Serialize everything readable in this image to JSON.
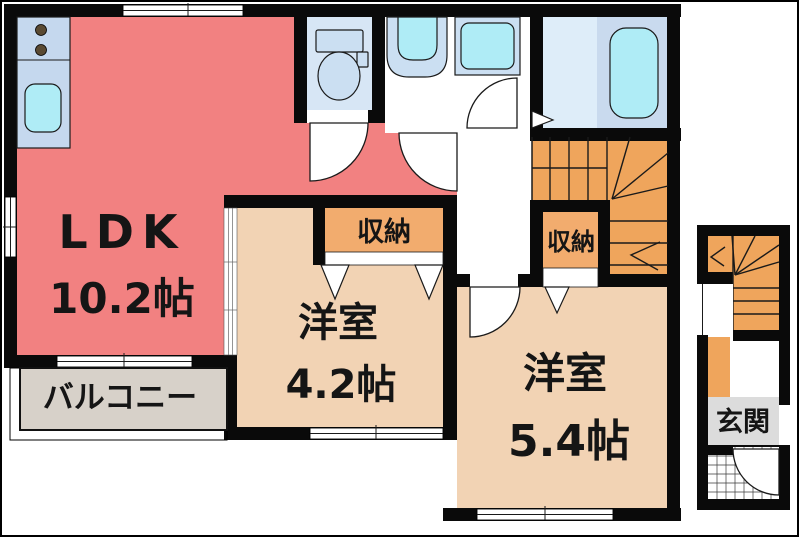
{
  "rooms": {
    "ldk": {
      "label": "LDK",
      "size": "10.2帖"
    },
    "room42": {
      "label": "洋室",
      "size": "4.2帖"
    },
    "room54": {
      "label": "洋室",
      "size": "5.4帖"
    },
    "closet1": {
      "label": "収納"
    },
    "closet2": {
      "label": "収納"
    },
    "balcony": {
      "label": "バルコニー"
    },
    "entrance": {
      "label": "玄関"
    }
  },
  "colors": {
    "wall": "#0a0a0a",
    "ldk_floor": "#F28181",
    "room_floor": "#F2D3B4",
    "closet_fill": "#F2AC6E",
    "stairs_fill": "#EFA55C",
    "balcony_fill": "#D7D1C9",
    "entrance_fill": "#DCDCDC",
    "toilet_floor": "#D7E6F5",
    "bath_floor": "#DEEDF9",
    "bath_panel": "#C9DAEE",
    "water_cyan": "#AFECF6",
    "fixture_blue": "#CBDFF2",
    "counter_blue": "#C5D8EE",
    "burner_dot": "#5A4A33"
  }
}
